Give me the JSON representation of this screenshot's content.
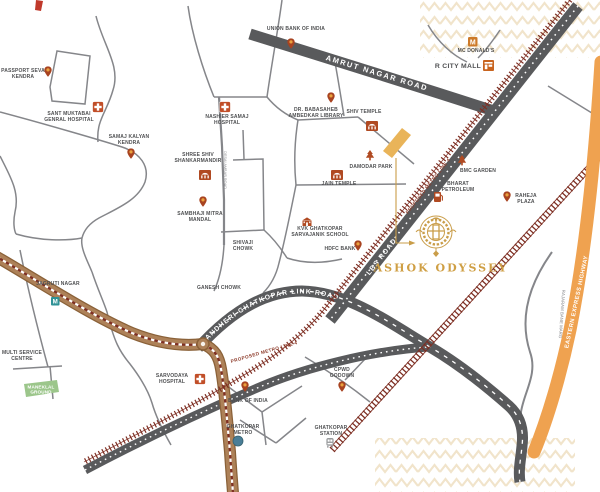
{
  "project": {
    "name": "ASHOK ODYSSEY"
  },
  "roads": {
    "amrut": "AMRUT NAGAR ROAD",
    "lbs": "LBS ROAD",
    "link": "ANDHERI GHATKOPAR LINK ROAD",
    "metro4": "PROPOSED METRO LINE 4",
    "eeh": "EASTERN EXPRESS HIGHWAY",
    "rajaram": "RAJARAM BANE MARG",
    "desai": "DESAI AMBAR ROAD"
  },
  "landmarks": {
    "passport": "PASSPORT SEVA\nKENDRA",
    "sant_muktabai": "SANT MUKTABAI\nGENRAL HOSPITAL",
    "samaj_kalyan": "SAMAJ KALYAN\nKENDRA",
    "union_bank": "UNION BANK OF INDIA",
    "mcdonalds": "MC DONALD'S",
    "r_city_mall": "R CITY MALL",
    "nashier": "NASHIER SAMAJ\nHOSPITAL",
    "ambedkar_library": "DR. BABASAHEB\nAMBEDKAR LIBRARY",
    "shiv_temple": "SHIV TEMPLE",
    "shankar_mandir": "SHREE SHIV\nSHANKARMANDIR",
    "damodar_park": "DAMODAR PARK",
    "jain_temple": "JAIN TEMPLE",
    "sambhaji": "SAMBHAJI MITRA\nMANDAL",
    "shivaji_chowk": "SHIVAJI\nCHOWK",
    "ganesh_chowk": "GANESH CHOWK",
    "kvk_school": "KVK GHATKOPAR\nSARVAJANIK SCHOOL",
    "hdfc": "HDFC BANK",
    "bmc_garden": "BMC GARDEN",
    "bharat_petroleum": "BHARAT\nPETROLEUM",
    "raheja_plaza": "RAHEJA\nPLAZA",
    "jagruti_nagar": "JAGRUTI NAGAR",
    "multi_service": "MULTI SERVICE\nCENTRE",
    "maneklal": "MANEKLAL\nGROUND",
    "sarvodaya": "SARVODAYA\nHOSPITAL",
    "bank_of_india": "BANK OF INDIA",
    "ghatkopar_metro": "GHATKOPAR\nMETRO",
    "cpwd": "CPWD\nGODOWN",
    "ghatkopar_station": "GHATKOPAR\nSTATION"
  },
  "icons": {
    "mcdonalds_letter": "M",
    "metro_letter": "M"
  },
  "colors": {
    "road_dark": "#595a5c",
    "road_minor": "#85868a",
    "metro_corridor_brown": "#ad8158",
    "metro_maroon": "#7e2f23",
    "highway_orange": "#efa250",
    "brand_gold": "#cf9f44",
    "site_gold": "#e9b459",
    "icon_rust": "#b04a22",
    "metro_teal": "#2f9296",
    "ground_green": "#9cc68b",
    "label_gray": "#4f5052"
  }
}
